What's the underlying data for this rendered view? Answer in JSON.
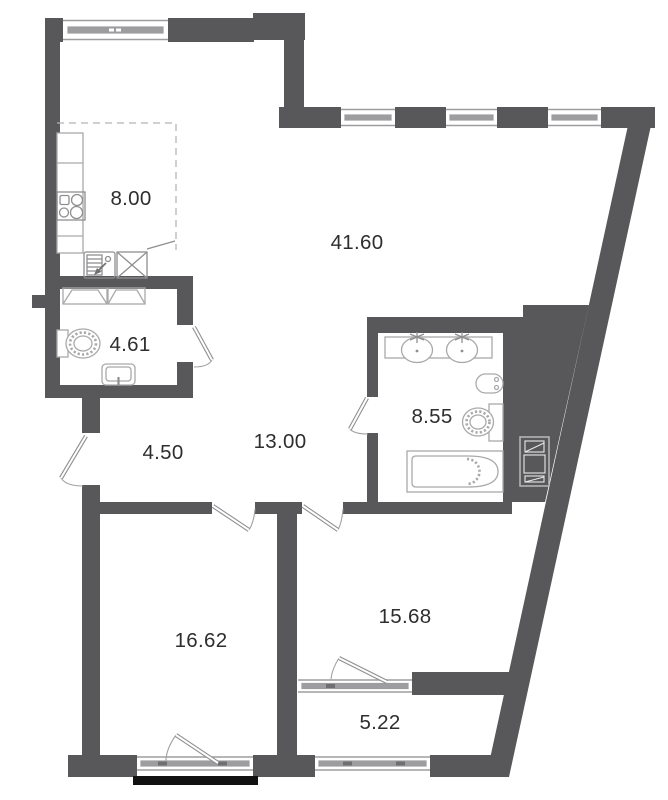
{
  "plan": {
    "rooms": [
      {
        "id": "kitchen",
        "area": "8.00"
      },
      {
        "id": "living-room",
        "area": "41.60"
      },
      {
        "id": "wc",
        "area": "4.61"
      },
      {
        "id": "bathroom",
        "area": "8.55"
      },
      {
        "id": "entrance-hall",
        "area": "4.50"
      },
      {
        "id": "corridor",
        "area": "13.00"
      },
      {
        "id": "bedroom-1",
        "area": "16.62"
      },
      {
        "id": "bedroom-2",
        "area": "15.68"
      },
      {
        "id": "loggia",
        "area": "5.22"
      }
    ],
    "colors": {
      "wall": "#58585a",
      "fixture_outline": "#a9a9ab",
      "window_band": "#9d9d9f",
      "railing": "#111111",
      "label_text": "#2e2e30",
      "background": "#ffffff"
    },
    "fixtures": {
      "kitchen": [
        "counter",
        "stove-4-burner-icon",
        "dishwasher-icon",
        "sink-cross-icon"
      ],
      "wc": [
        "wardrobe-icon",
        "toilet-icon",
        "washbasin-icon"
      ],
      "bathroom": [
        "vanity-two-sinks-icon",
        "bidet-icon",
        "toilet-icon",
        "bathtub-icon"
      ],
      "service": [
        "ventilation-shaft-icon",
        "balcony-railing"
      ]
    }
  }
}
